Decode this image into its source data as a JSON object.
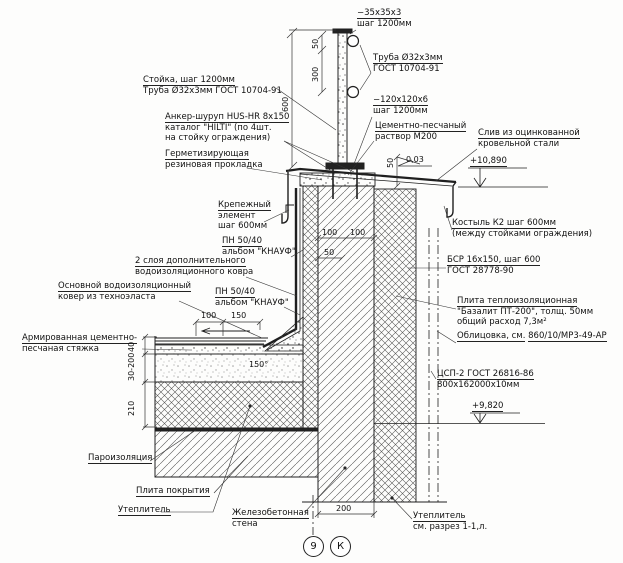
{
  "drawing": {
    "type": "construction-detail-parapet-section",
    "line_color": "#1f1f1f",
    "background": "#fdfdfc"
  },
  "annotations": {
    "cap_plate": {
      "l1": "−35x35x3",
      "l2": "шаг 1200мм"
    },
    "pipe_top": {
      "l1": "Труба Ø32x3мм",
      "l2": "ГОСТ 10704-91"
    },
    "post": {
      "l1": "Стойка, шаг 1200мм",
      "l2": "Труба Ø32x3мм ГОСТ 10704-91"
    },
    "anchor": {
      "l1": "Анкер-шуруп HUS-HR 8x150",
      "l2": "каталог \"HILTI\" (по 4шт.",
      "l3": "на стойку ограждения)"
    },
    "gasket": {
      "l1": "Герметизирующая",
      "l2": "резиновая прокладка"
    },
    "base_plate": {
      "l1": "−120x120x6",
      "l2": "шаг 1200мм"
    },
    "mortar": {
      "l1": "Цементно-песчаный",
      "l2": "раствор М200"
    },
    "drip": {
      "l1": "Слив из оцинкованной",
      "l2": "кровельной стали"
    },
    "slope": "0,03",
    "level_top": "+10,890",
    "crutch": {
      "l1": "Костыль К2 шаг 600мм",
      "l2": "(между стойками ограждения)"
    },
    "fastener": {
      "l1": "Крепежный",
      "l2": "элемент",
      "l3": "шаг 600мм"
    },
    "pn_profile_1": {
      "l1": "ПН 50/40",
      "l2": "альбом \"КНАУФ\""
    },
    "extra_carpet": {
      "l1": "2 слоя дополнительного",
      "l2": "водоизоляционного ковра"
    },
    "main_carpet": {
      "l1": "Основной водоизоляционный",
      "l2": "ковер из техноэласта"
    },
    "pn_profile_2": {
      "l1": "ПН 50/40",
      "l2": "альбом \"КНАУФ\""
    },
    "screed": {
      "l1": "Армированная цементно-",
      "l2": "песчаная стяжка"
    },
    "bsr": {
      "l1": "БСР 16x150, шаг 600",
      "l2": "ГОСТ 28778-90"
    },
    "thermo_plate": {
      "l1": "Плита теплоизоляционная",
      "l2": "\"Базалит ПТ-200\", толщ. 50мм",
      "l3": "общий расход 7,3м²"
    },
    "cladding": {
      "l1": "Облицовка, см.",
      "l2": "860/10/МР3-49-АР"
    },
    "csp": {
      "l1": "ЦСП-2 ГОСТ 26816-86",
      "l2": "800x162000x10мм"
    },
    "level_mid": "+9,820",
    "vapor": "Пароизоляция",
    "deck": "Плита покрытия",
    "insulation_left": "Утеплитель",
    "wall": {
      "l1": "Железобетонная",
      "l2": "стена"
    },
    "insulation_right": {
      "l1": "Утеплитель",
      "l2": "см. разрез 1-1,л."
    },
    "axis_9": "9",
    "axis_k": "К"
  },
  "dimensions": {
    "d600": "600",
    "d50_top": "50",
    "d300": "300",
    "d100a": "100",
    "d100b": "100",
    "d50_wall": "50",
    "d50_coping": "50",
    "d100_roof": "100",
    "d150_roof": "150",
    "angle150": "150°",
    "d40": "40",
    "d30_200": "30-200",
    "d210": "210",
    "d200": "200"
  }
}
